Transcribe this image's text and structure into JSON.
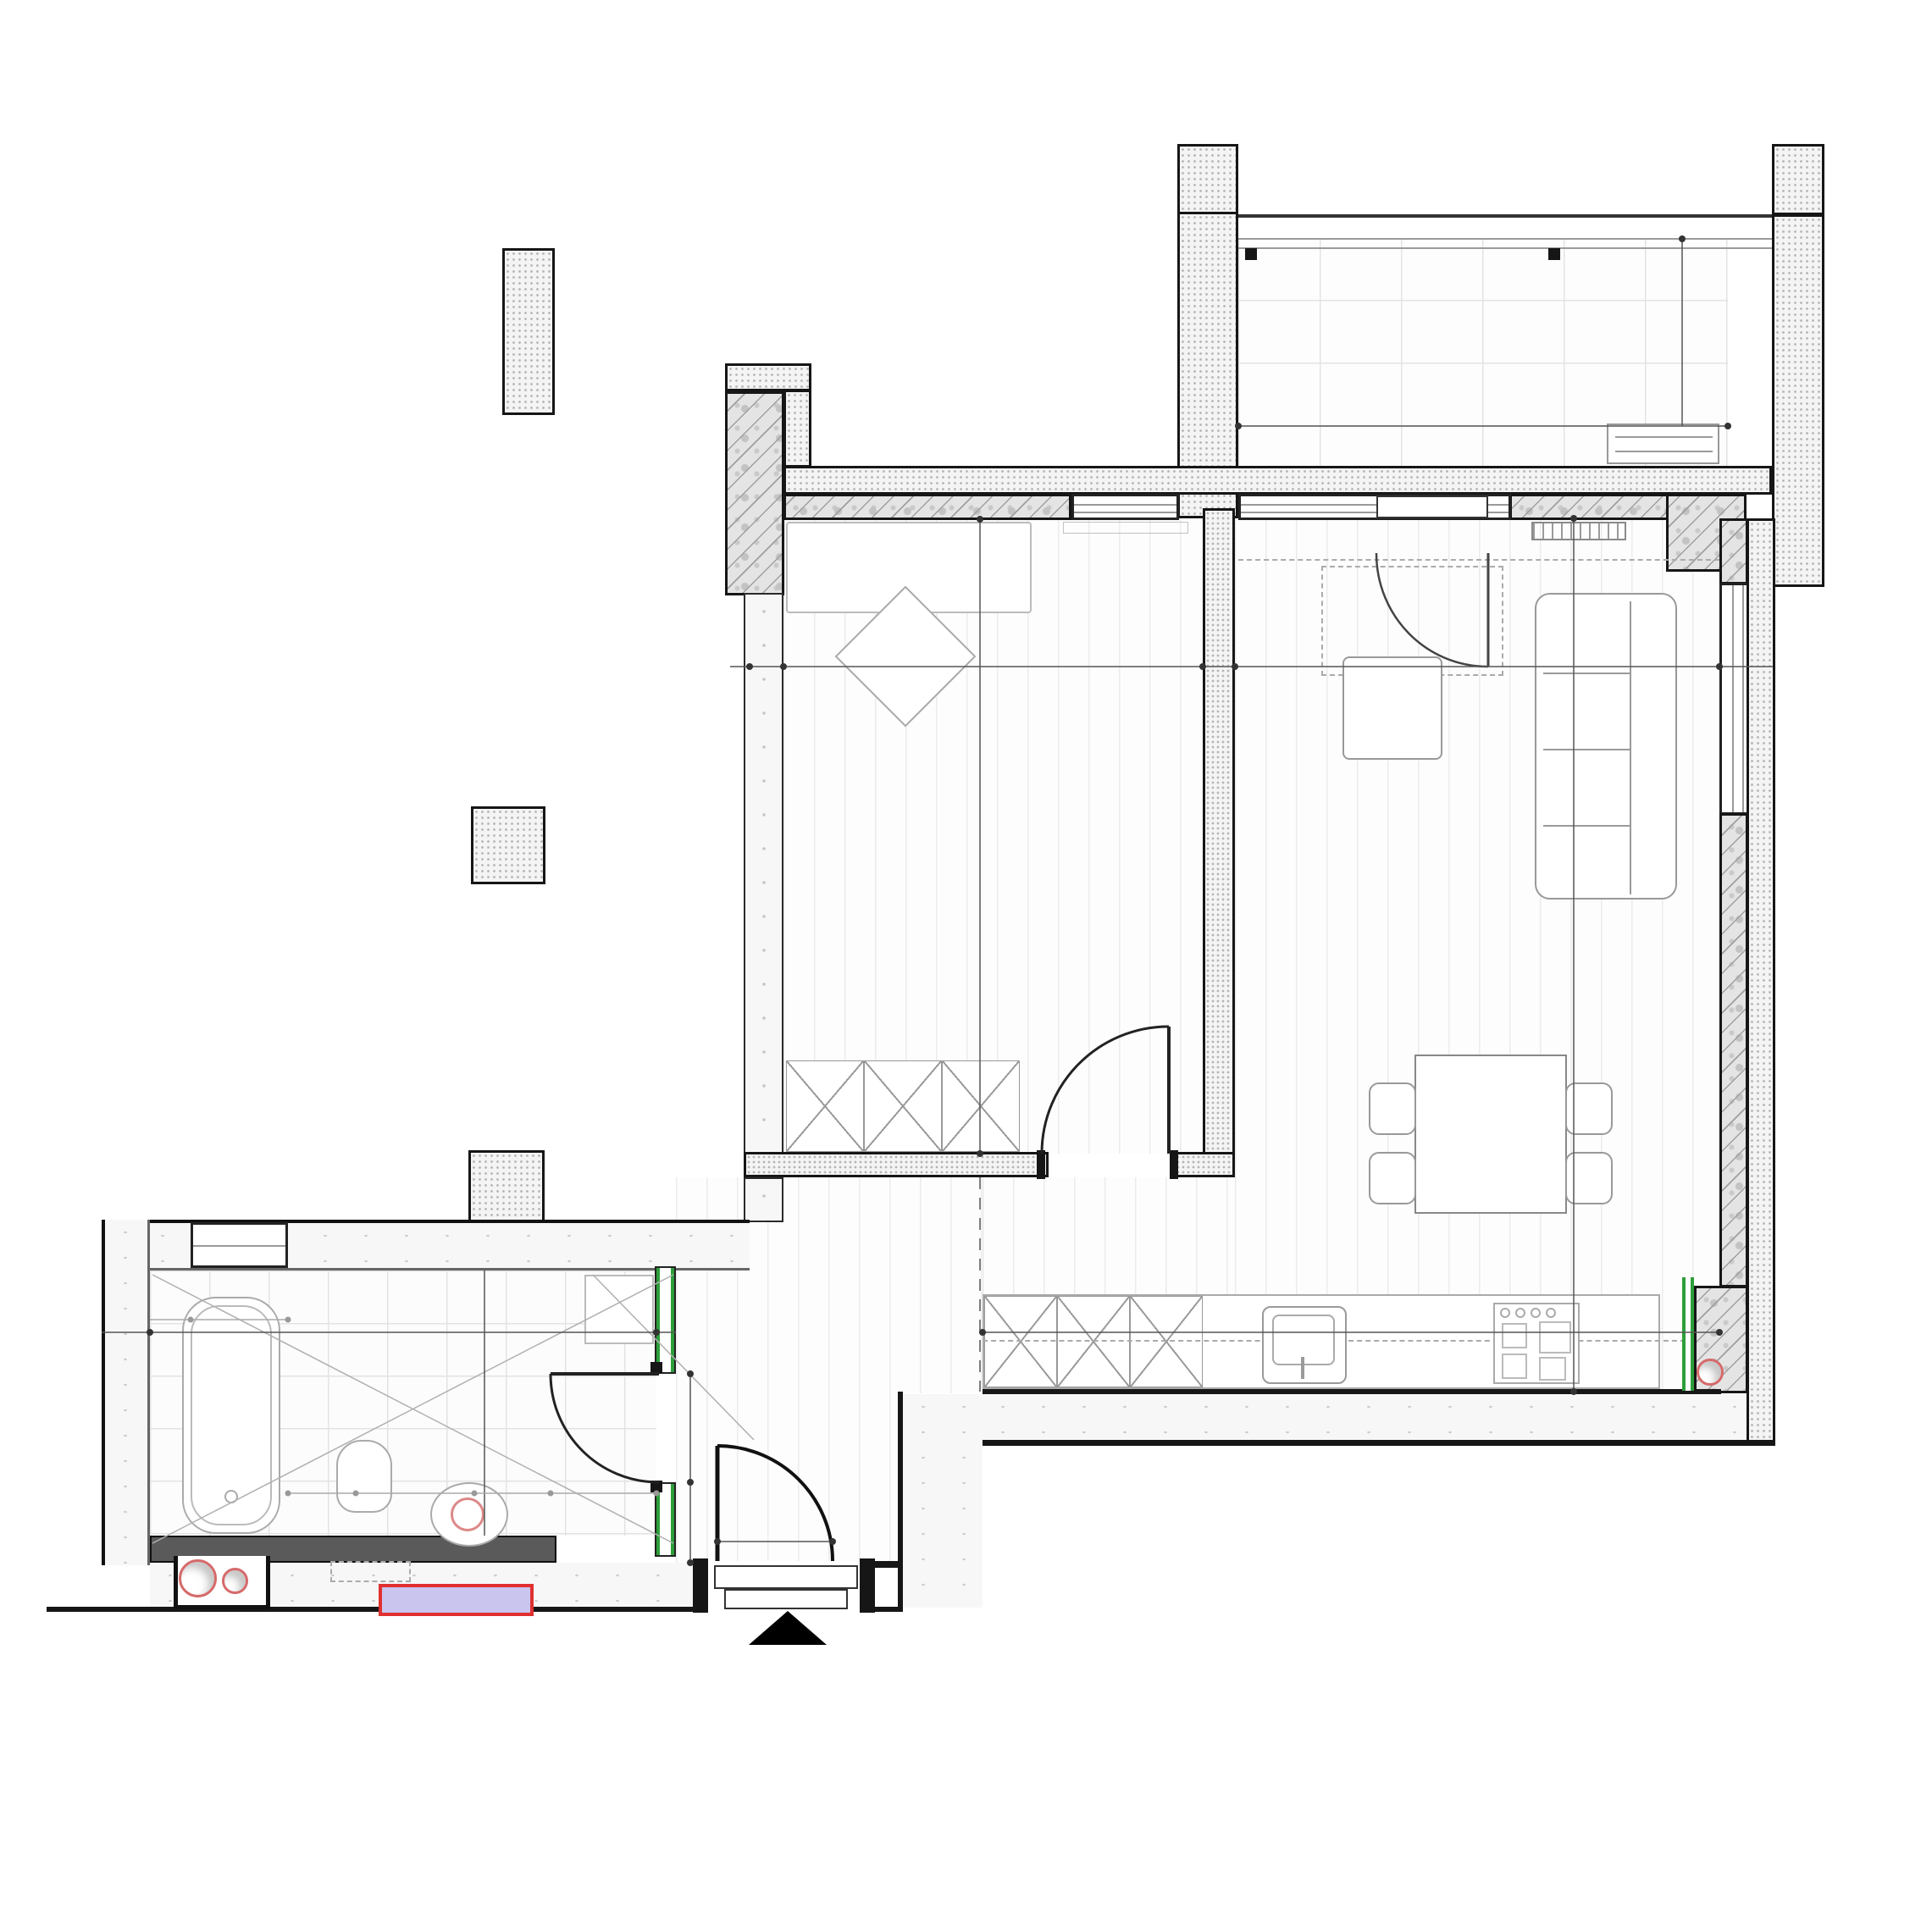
{
  "meta": {
    "caption_line1": "Ap. 02/B",
    "caption_line2": "AP. 1 Cam. Su=40.65mp"
  },
  "rooms": {
    "balcon": {
      "name": "Balcon",
      "area": "Au: 4.88 m²",
      "finish": "gresie"
    },
    "birou": {
      "name": "Birou",
      "area": "Au: 11.04 m²",
      "finish": "parchet",
      "height": "H: 2.670 m"
    },
    "living": {
      "name": "Living+buc.+sufragerie",
      "area": "Au: 20.02 m²",
      "finish": "parchet",
      "height": "H: 2.670 m"
    },
    "baie": {
      "name": "Baie",
      "area": "Au: 6.22 m²",
      "finish": "gresie",
      "height": "H: 2.670 m"
    },
    "hol": {
      "name": "Hol",
      "area": "Au: 3.37 m²",
      "finish": "parchet",
      "height": "H: 2.670 m"
    }
  },
  "dims": {
    "wall_left_birou": "27",
    "birou_width": "2.70",
    "wall_mid": "12⁵",
    "living_width": "3.09",
    "balcon_width": "3.07",
    "balcon_depth": "1.59",
    "wall_45": "45",
    "birou_depth": "4.09",
    "living_depth": "5.50⁵",
    "wall_birou_hol": "12⁵",
    "hol_to_kitchen": "1.39",
    "kitchen_width": "6.69",
    "baie_wall_left": "26",
    "baie_width": "3.17⁵",
    "baie_wall_right": "12⁵",
    "baie_depth": "2.02",
    "baie_wall_top": "27",
    "mt_wall": "27",
    "strip_left": "27",
    "strip_right": "27",
    "hp_top": "hp=1.20",
    "hp_bottom": "hp=1.20",
    "win_80": "80",
    "win_13": "13",
    "fix_50a": "50",
    "fix_70": "70",
    "fix_50b": "50",
    "fix_745": "74⁵",
    "fix_170": "1.70",
    "fix_1820": "18,20",
    "door_baie_w": "78",
    "door_baie_h": "2.06",
    "seg_41": "41",
    "door_entry_w": "92",
    "door_entry_h": "2.06"
  },
  "labels": {
    "washing_machine": "M",
    "kitchen_f": "F",
    "mt": "M.T."
  },
  "colors": {
    "green_pipe": "#2e9e3a",
    "red_marker": "#e03030",
    "mt_fill": "#c9c5ef"
  }
}
